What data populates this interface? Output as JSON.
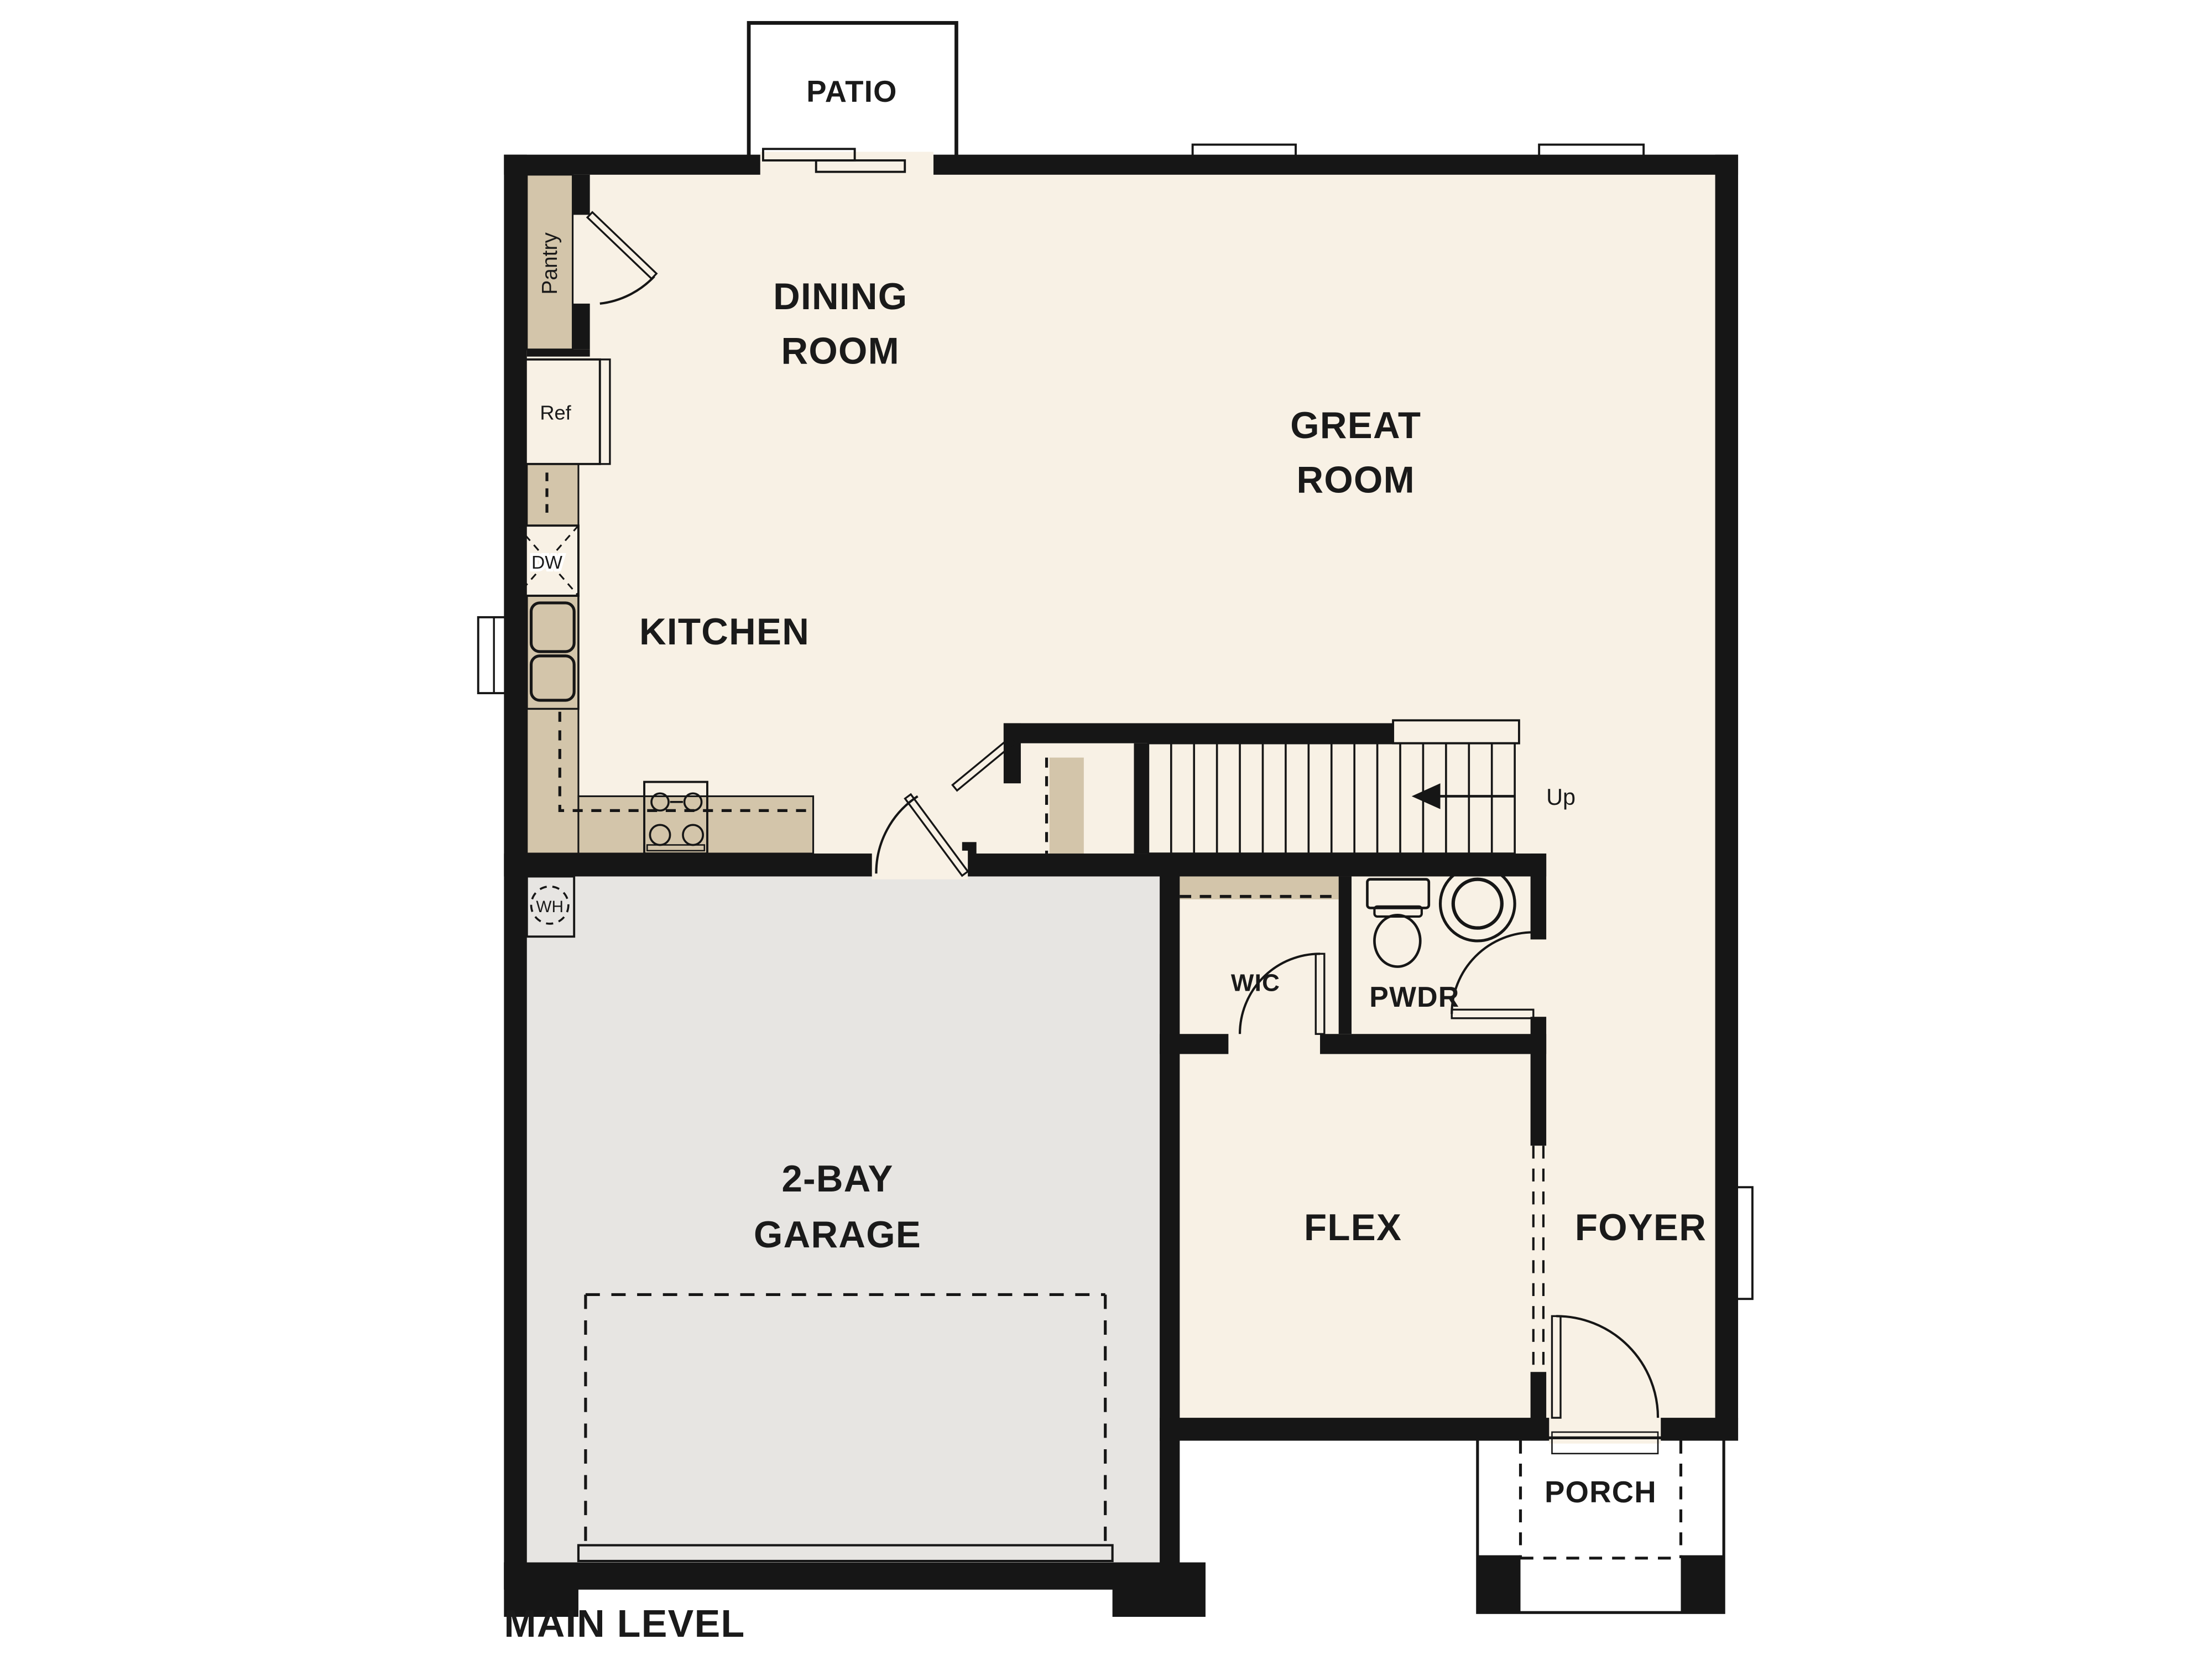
{
  "plan": {
    "title": "MAIN LEVEL",
    "rooms": {
      "patio": "PATIO",
      "dining_line1": "DINING",
      "dining_line2": "ROOM",
      "great_line1": "GREAT",
      "great_line2": "ROOM",
      "kitchen": "KITCHEN",
      "pantry": "Pantry",
      "garage_line1": "2-BAY",
      "garage_line2": "GARAGE",
      "flex": "FLEX",
      "foyer": "FOYER",
      "pwdr": "PWDR",
      "wic": "WIC",
      "porch": "PORCH"
    },
    "fixtures": {
      "refrigerator": "Ref",
      "dishwasher": "DW",
      "water_heater": "WH",
      "stairs_direction": "Up"
    }
  },
  "colors": {
    "wall": "#161616",
    "floor": "#f8f1e5",
    "concrete": "#e7e5e2",
    "counter": "#d3c5aa",
    "appliance": "#eae9e6",
    "blue": "#a9c9e7",
    "label": "#1a1a1a",
    "bg": "#ffffff"
  }
}
